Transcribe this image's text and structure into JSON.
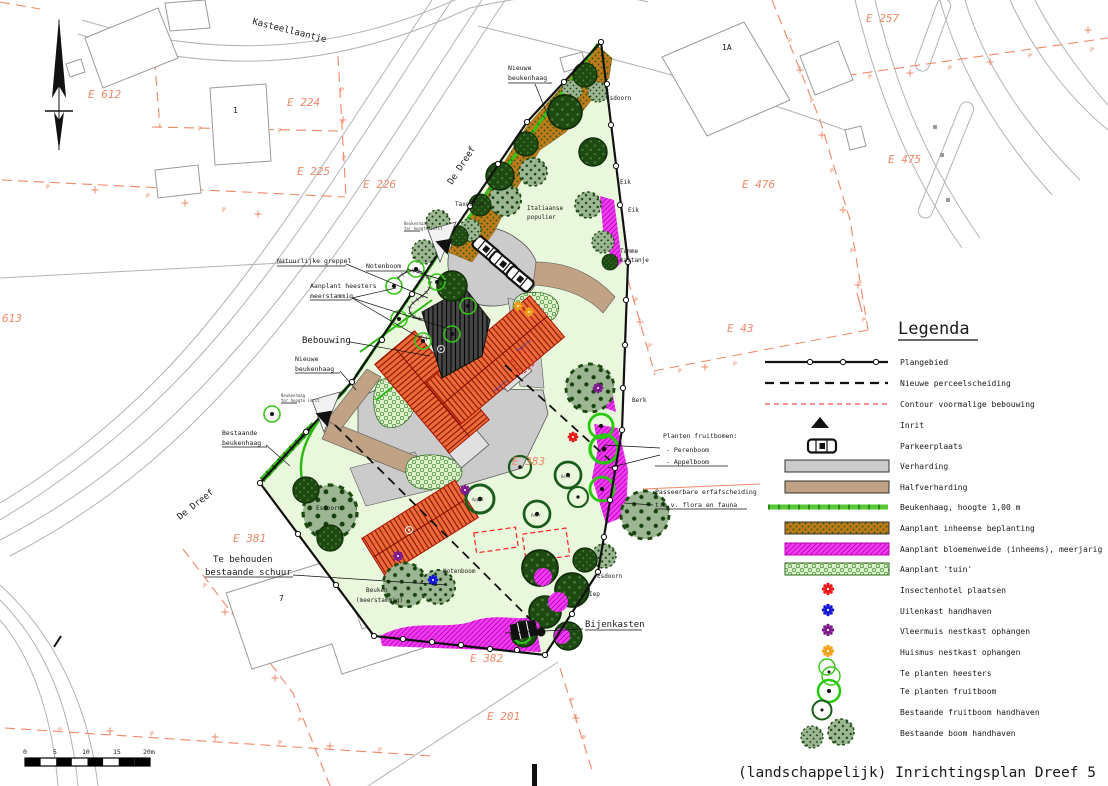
{
  "title": "(landschappelijk) Inrichtingsplan Dreef 5",
  "legend": {
    "title": "Legenda",
    "items": [
      {
        "symbol": "plangebied-line",
        "label": "Plangebied"
      },
      {
        "symbol": "dashed-line",
        "label": "Nieuwe perceelscheiding"
      },
      {
        "symbol": "red-dashed-line",
        "label": "Contour voormalige bebouwing"
      },
      {
        "symbol": "inrit-triangle",
        "label": "Inrit"
      },
      {
        "symbol": "car-icon",
        "label": "Parkeerplaats"
      },
      {
        "symbol": "verharding-swatch",
        "label": "Verharding"
      },
      {
        "symbol": "halfverharding-swatch",
        "label": "Halfverharding"
      },
      {
        "symbol": "beukenhaag-line",
        "label": "Beukenhaag, hoogte 1,00 m"
      },
      {
        "symbol": "inheemse-beplanting-swatch",
        "label": "Aanplant inheemse beplanting"
      },
      {
        "symbol": "bloemenweide-swatch",
        "label": "Aanplant bloemenweide (inheems), meerjarig"
      },
      {
        "symbol": "tuin-swatch",
        "label": "Aanplant 'tuin'"
      },
      {
        "symbol": "insectenhotel-marker",
        "label": "Insectenhotel plaatsen"
      },
      {
        "symbol": "uilenkast-marker",
        "label": "Uilenkast handhaven"
      },
      {
        "symbol": "vleermuis-marker",
        "label": "Vleermuis nestkast ophangen"
      },
      {
        "symbol": "huismus-marker",
        "label": "Huismus nestkast ophangen"
      },
      {
        "symbol": "heesters-rings",
        "label": "Te planten heesters"
      },
      {
        "symbol": "fruitboom-ring",
        "label": "Te planten fruitboom"
      },
      {
        "symbol": "bestaande-fruitboom-ring",
        "label": "Bestaande fruitboom handhaven"
      },
      {
        "symbol": "bestaande-boom-trees",
        "label": "Bestaande boom handhaven"
      }
    ]
  },
  "map": {
    "glyph_p": "P",
    "streets": {
      "kasteellaantje": "Kasteellaantje",
      "de_dreef_upper": "De Dreef",
      "de_dreef_lower": "De Dreef"
    },
    "parcels": {
      "e612": "E 612",
      "e224": "E 224",
      "e225": "E 225",
      "e226": "E 226",
      "e257": "E 257",
      "e475": "E 475",
      "e476": "E 476",
      "e613": "613",
      "e383": "E 383",
      "e381": "E 381",
      "e382": "E 382",
      "e201": "E 201",
      "e43": "E 43"
    },
    "buildings": {
      "b1": "1",
      "b1a": "1A",
      "b7": "7"
    },
    "labels": {
      "nieuwe_haag_top_1": "Nieuwe",
      "nieuwe_haag_top_2": "beukenhaag",
      "esdoorn_ne": "Esdoorn",
      "taxodium": "Taxodium",
      "populier_1": "Italiaanse",
      "populier_2": "populier",
      "eik_1": "Eik",
      "eik_2": "Eik",
      "kastanje_1": "Tamme",
      "kastanje_2": "kastanje",
      "greppel": "Natuurlijke greppel",
      "notenboom_n": "Notenboom",
      "heesters_1": "Aanplant heesters",
      "heesters_2": "meerstammig",
      "bebouwing": "Bebouwing",
      "nieuwe_haag_w_1": "Nieuwe",
      "nieuwe_haag_w_2": "beukenhaag",
      "bestaande_haag_1": "Bestaande",
      "bestaande_haag_2": "beukenhaag",
      "berk": "Berk",
      "fruitbomen_1": "Planten fruitbomen:",
      "fruitbomen_2": "- Perenboom",
      "fruitbomen_3": "- Appelboom",
      "erfafscheiding_1": "Passeerbare erfafscheiding",
      "erfafscheiding_2": "t.b.v. flora en fauna",
      "schuur_1": "Te behouden",
      "schuur_2": "bestaande schuur",
      "beuken_1": "Beuken",
      "beuken_2": "(meerstammig)",
      "notenboom_s": "Notenboom",
      "esdoorn_se": "Esdoorn",
      "iep": "Iep",
      "bijenkasten": "Bijenkasten",
      "esdoorn_w": "Esdoorn",
      "appel": "Appel",
      "peer": "Peer",
      "kers": "Kers",
      "inrit_note_1": "Beukenhaag",
      "inrit_note_2": "ter hoogte inrit",
      "regenton": "Regenton"
    },
    "scale": {
      "t0": "0",
      "t5": "5",
      "t10": "10",
      "t15": "15",
      "t20": "20m"
    }
  },
  "colors": {
    "cadastral": "#f08868",
    "plan_green": "#e9f8dd",
    "magenta": "#f03cf0",
    "hedge_green": "#35c614",
    "fruit_ring_green": "#28c80a",
    "dark_ring": "#1a5c1a",
    "orange_band": "#c17a18",
    "roof_orange": "#ed6b3a",
    "roof_dark": "#404040",
    "verharding": "#cbcbcb",
    "halfverharding": "#c2a284",
    "insectenhotel": "#e81818",
    "uilenkast": "#1616d8",
    "vleermuis": "#7c1a8c",
    "huismus": "#f0a018",
    "tree_medium": "#9cb694",
    "tree_dark": "#1d4a10"
  }
}
